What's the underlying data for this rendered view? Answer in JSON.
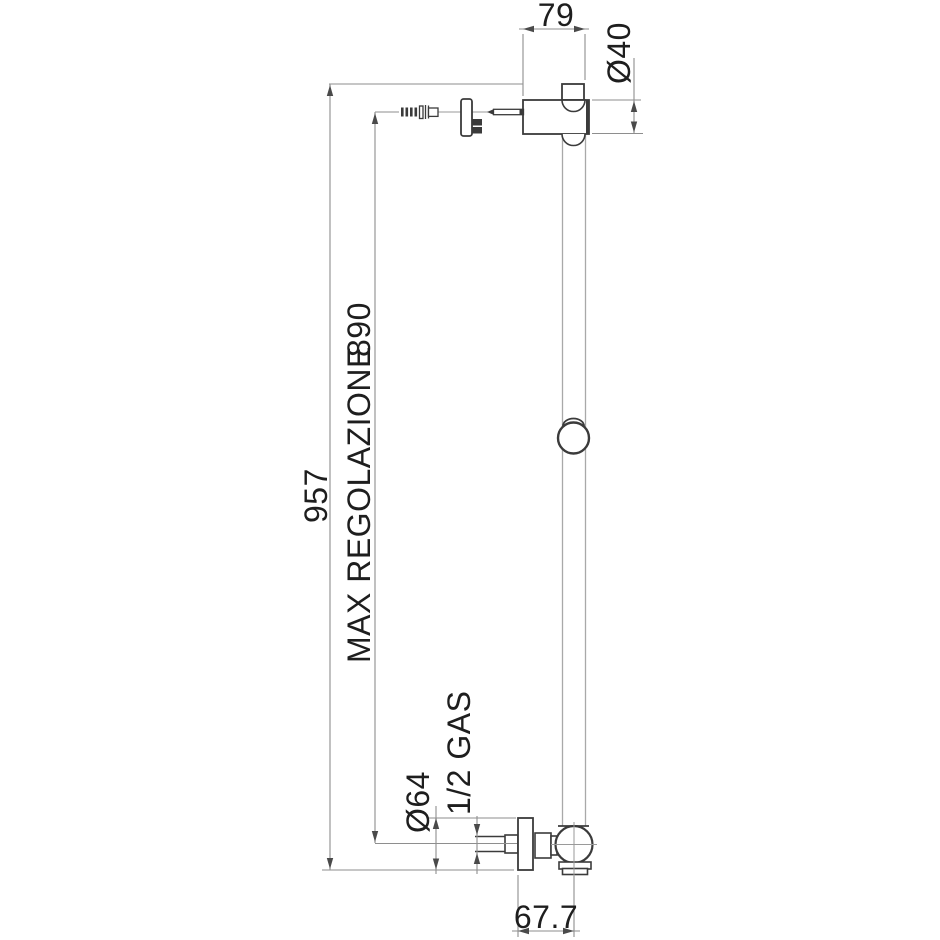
{
  "colors": {
    "background": "#ffffff",
    "outline": "#3b3b3b",
    "dimension_line": "#8e8e8e",
    "rail_line": "#a9a9a9",
    "text": "#1e1e1e"
  },
  "dims": {
    "top_width": {
      "value": "79"
    },
    "bracket_diameter": {
      "value": "Ø40"
    },
    "total_height": {
      "value": "957"
    },
    "max_adjustment": {
      "label": "MAX REGOLAZIONE",
      "value": "890"
    },
    "outlet_flange_diameter": {
      "value": "Ø64"
    },
    "connection_thread": {
      "value": "1/2 GAS"
    },
    "wall_to_axis_offset": {
      "value": "67.7"
    }
  }
}
